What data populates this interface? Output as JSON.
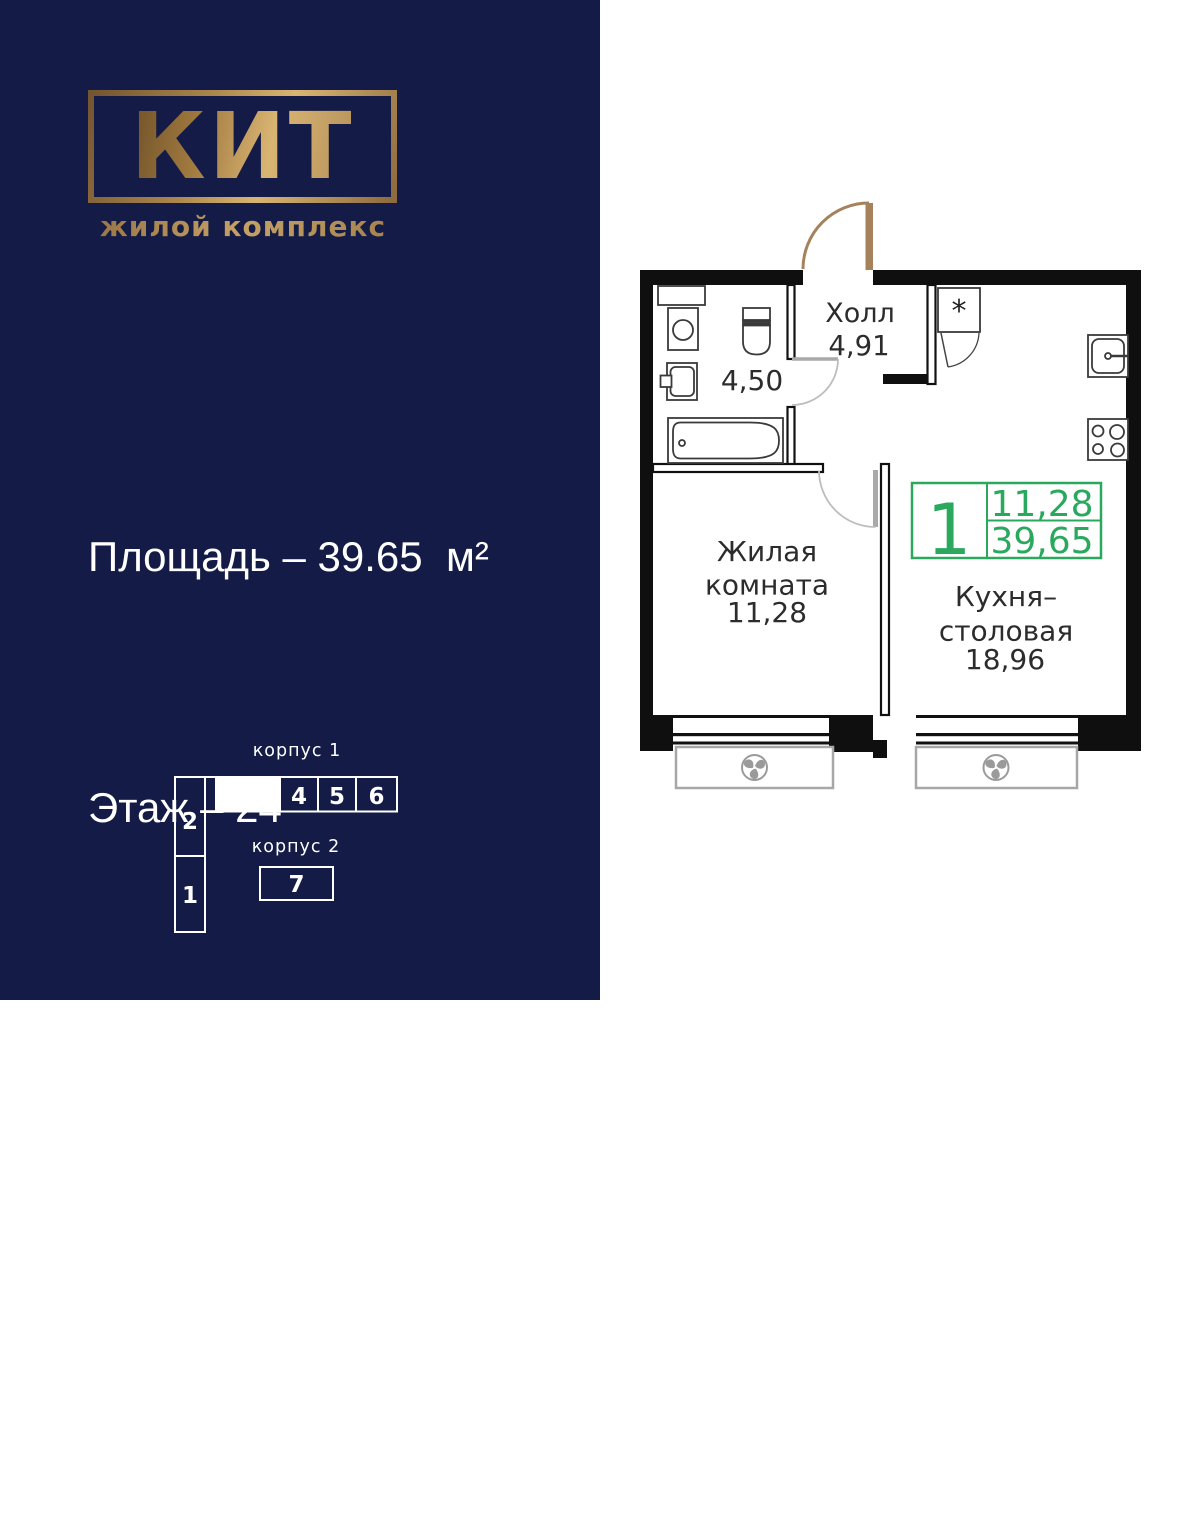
{
  "brand": {
    "logo": "КИТ",
    "subtitle": "жилой комплекс"
  },
  "details": {
    "lines": [
      "Площадь – 39.65  м²",
      "Этаж – 24",
      "Комнат – 1",
      "Отделка – Без отделки"
    ]
  },
  "scheme": {
    "korpus1_label": "корпус 1",
    "korpus2_label": "корпус 2",
    "sections": {
      "n1": "1",
      "n2": "2",
      "n4": "4",
      "n5": "5",
      "n6": "6",
      "n7": "7"
    }
  },
  "plan": {
    "hall": {
      "name": "Холл",
      "area": "4,91"
    },
    "bathroom": {
      "area": "4,50"
    },
    "living": {
      "line1": "Жилая",
      "line2": "комната",
      "area": "11,28"
    },
    "kitchen": {
      "line1": "Кухня–",
      "line2": "столовая",
      "area": "18,96"
    },
    "closet_symbol": "*",
    "badge": {
      "rooms": "1",
      "living_area": "11,28",
      "total_area": "39,65"
    }
  },
  "colors": {
    "navy": "#131b46",
    "gold": "#b2905a",
    "green": "#2aa85e",
    "door_brown": "#a5825c"
  }
}
